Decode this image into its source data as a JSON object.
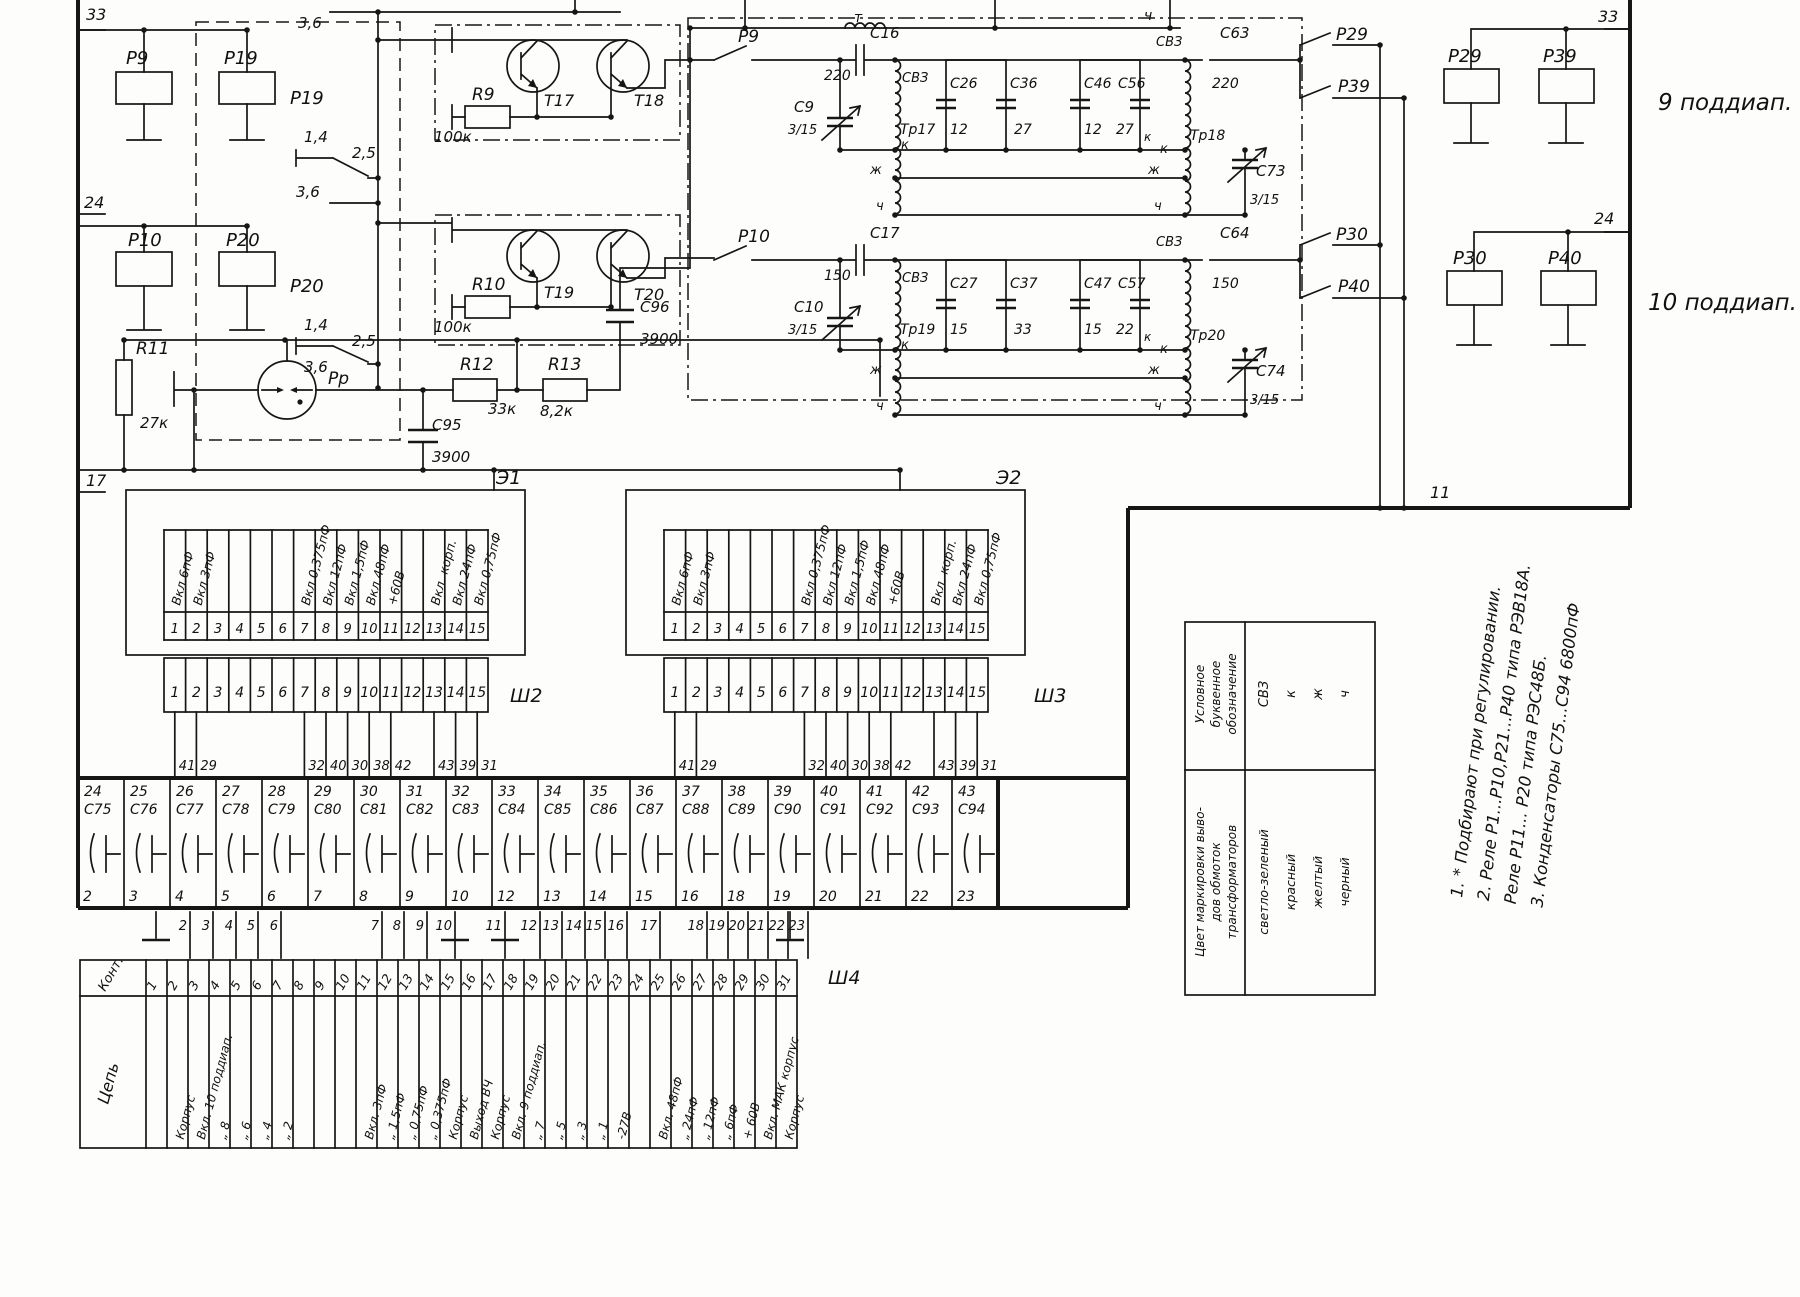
{
  "border": {
    "l33": "33",
    "l24": "24",
    "l17": "17",
    "r33": "33",
    "r24": "24"
  },
  "misc": {
    "e1": "Э1",
    "e2": "Э2",
    "sh2": "Ш2",
    "sh3": "Ш3",
    "sh4": "Ш4",
    "w11": "11",
    "band9": "9 поддиап.",
    "band10": "10 поддиап.",
    "t_mark": "т",
    "ch_top": "ч",
    "kont": "Конт.",
    "cep": "Цепь"
  },
  "relays": {
    "p9": "Р9",
    "p19": "Р19",
    "p10": "Р10",
    "p20": "Р20",
    "p29": "Р29",
    "p39": "Р39",
    "p30": "Р30",
    "p40": "Р40"
  },
  "sw": {
    "p19l": "Р19",
    "p19c14": "1,4",
    "p19c25": "2,5",
    "p19c36a": "3,6",
    "p19c36b": "3,6",
    "p20l": "Р20",
    "p20c14": "1,4",
    "p20c25": "2,5",
    "p20c36": "3,6",
    "rp": "Рр"
  },
  "amp_top": {
    "r": "R9",
    "rv": "100к",
    "t1": "Т17",
    "t2": "Т18"
  },
  "amp_bot": {
    "r": "R10",
    "rv": "100к",
    "t1": "Т19",
    "t2": "Т20"
  },
  "rc": {
    "r11": "R11",
    "r11v": "27к",
    "r12": "R12",
    "r12v": "33к",
    "r13": "R13",
    "r13v": "8,2к",
    "c95": "С95",
    "c95v": "3900",
    "c96": "С96",
    "c96v": "3900"
  },
  "flt": {
    "p9": "Р9",
    "c16": "С16",
    "c16v": "220",
    "c9": "С9",
    "c9v": "3/15",
    "svz1": "СВЗ",
    "tr1": "Тр17",
    "k1": "к",
    "zh1": "ж",
    "ch1": "ч",
    "c26": "С26",
    "c26v": "12",
    "c36": "С36",
    "c36v": "27",
    "c46": "С46",
    "c46v": "12",
    "c56": "С56",
    "c56v": "27",
    "k2": "к",
    "svz2": "СВЗ",
    "tr2": "Тр18",
    "zh2": "ж",
    "ch2": "ч",
    "k3": "к",
    "c63": "С63",
    "c63v": "220",
    "c73": "С73",
    "c73v": "3/15",
    "p29": "Р29",
    "p39": "Р39"
  },
  "flb": {
    "p10": "Р10",
    "c17": "С17",
    "c17v": "150",
    "c10": "С10",
    "c10v": "3/15",
    "svz1": "СВЗ",
    "tr1": "Тр19",
    "k1": "к",
    "zh1": "ж",
    "ch1": "ч",
    "c27": "С27",
    "c27v": "15",
    "c37": "С37",
    "c37v": "33",
    "c47": "С47",
    "c47v": "15",
    "c57": "С57",
    "c57v": "22",
    "k2": "к",
    "svz2": "СВЗ",
    "tr2": "Тр20",
    "zh2": "ж",
    "ch2": "ч",
    "k3": "к",
    "c64": "С64",
    "c64v": "150",
    "c74": "С74",
    "c74v": "3/15",
    "p30": "Р30",
    "p40": "Р40"
  },
  "e_cols": [
    {
      "n": "1",
      "t": "Вкл.6пФ"
    },
    {
      "n": "2",
      "t": "Вкл.3пФ"
    },
    {
      "n": "3",
      "t": ""
    },
    {
      "n": "4",
      "t": ""
    },
    {
      "n": "5",
      "t": ""
    },
    {
      "n": "6",
      "t": ""
    },
    {
      "n": "7",
      "t": "Вкл.0,375пФ"
    },
    {
      "n": "8",
      "t": "Вкл.12пФ"
    },
    {
      "n": "9",
      "t": "Вкл.1,5пФ"
    },
    {
      "n": "10",
      "t": "Вкл.48пФ"
    },
    {
      "n": "11",
      "t": "+60В"
    },
    {
      "n": "12",
      "t": ""
    },
    {
      "n": "13",
      "t": "Вкл. корп."
    },
    {
      "n": "14",
      "t": "Вкл.24пФ"
    },
    {
      "n": "15",
      "t": "Вкл.0,75пФ"
    }
  ],
  "wires_sh": [
    "41",
    "29",
    "32",
    "40",
    "30",
    "38",
    "42",
    "43",
    "39",
    "31"
  ],
  "band_cells": [
    {
      "top": "24",
      "ref": "С75",
      "bot": "2"
    },
    {
      "top": "25",
      "ref": "С76",
      "bot": "3"
    },
    {
      "top": "26",
      "ref": "С77",
      "bot": "4"
    },
    {
      "top": "27",
      "ref": "С78",
      "bot": "5"
    },
    {
      "top": "28",
      "ref": "С79",
      "bot": "6"
    },
    {
      "top": "29",
      "ref": "С80",
      "bot": "7"
    },
    {
      "top": "30",
      "ref": "С81",
      "bot": "8"
    },
    {
      "top": "31",
      "ref": "С82",
      "bot": "9"
    },
    {
      "top": "32",
      "ref": "С83",
      "bot": "10"
    },
    {
      "top": "33",
      "ref": "С84",
      "bot": "12"
    },
    {
      "top": "34",
      "ref": "С85",
      "bot": "13"
    },
    {
      "top": "35",
      "ref": "С86",
      "bot": "14"
    },
    {
      "top": "36",
      "ref": "С87",
      "bot": "15"
    },
    {
      "top": "37",
      "ref": "С88",
      "bot": "16"
    },
    {
      "top": "38",
      "ref": "С89",
      "bot": "18"
    },
    {
      "top": "39",
      "ref": "С90",
      "bot": "19"
    },
    {
      "top": "40",
      "ref": "С91",
      "bot": "20"
    },
    {
      "top": "41",
      "ref": "С92",
      "bot": "21"
    },
    {
      "top": "42",
      "ref": "С93",
      "bot": "22"
    },
    {
      "top": "43",
      "ref": "С94",
      "bot": "23"
    }
  ],
  "wires_band": [
    "2",
    "3",
    "4",
    "5",
    "6",
    "7",
    "8",
    "9",
    "10",
    "11",
    "12",
    "13",
    "14",
    "15",
    "16",
    "17",
    "18",
    "19",
    "20",
    "21",
    "22",
    "23"
  ],
  "sh4_cols": [
    {
      "n": "1",
      "t": ""
    },
    {
      "n": "2",
      "t": "Корпус"
    },
    {
      "n": "3",
      "t": "Вкл. 10 поддиап."
    },
    {
      "n": "4",
      "t": "„ 8"
    },
    {
      "n": "5",
      "t": "„ 6"
    },
    {
      "n": "6",
      "t": "„ 4"
    },
    {
      "n": "7",
      "t": "„ 2"
    },
    {
      "n": "8",
      "t": ""
    },
    {
      "n": "9",
      "t": ""
    },
    {
      "n": "10",
      "t": ""
    },
    {
      "n": "11",
      "t": "Вкл. 3пФ"
    },
    {
      "n": "12",
      "t": "„ 1,5пФ"
    },
    {
      "n": "13",
      "t": "„ 0,75пФ"
    },
    {
      "n": "14",
      "t": "„ 0,375пФ"
    },
    {
      "n": "15",
      "t": "Корпус"
    },
    {
      "n": "16",
      "t": "Выход ВЧ"
    },
    {
      "n": "17",
      "t": "Корпус"
    },
    {
      "n": "18",
      "t": "Вкл. 9 поддиап."
    },
    {
      "n": "19",
      "t": "„ 7"
    },
    {
      "n": "20",
      "t": "„ 5"
    },
    {
      "n": "21",
      "t": "„ 3"
    },
    {
      "n": "22",
      "t": "„ 1"
    },
    {
      "n": "23",
      "t": "-27В"
    },
    {
      "n": "24",
      "t": ""
    },
    {
      "n": "25",
      "t": "Вкл. 48пФ"
    },
    {
      "n": "26",
      "t": "„ 24пФ"
    },
    {
      "n": "27",
      "t": "„ 12пФ"
    },
    {
      "n": "28",
      "t": "„ 6пФ"
    },
    {
      "n": "29",
      "t": "+ 60В"
    },
    {
      "n": "30",
      "t": "Вкл. МАК корпус"
    },
    {
      "n": "31",
      "t": "Корпус"
    }
  ],
  "color_table": {
    "h1": [
      "Условное",
      "буквенное",
      "обозначение"
    ],
    "h2": [
      "Цвет маркировки выво-",
      "дов обмоток",
      "трансформаторов"
    ],
    "codes": [
      "СВЗ",
      "к",
      "ж",
      "ч"
    ],
    "colors": [
      "светло-зеленый",
      "красный",
      "желтый",
      "черный"
    ]
  },
  "notes": [
    "1. * Подбирают  при  регулировании.",
    "2. Реле Р1...Р10,Р21...Р40  типа  РЭВ18А.",
    "Реле Р11... Р20   типа   РЭС48Б.",
    "3. Конденсаторы  С75...С94   6800пФ"
  ]
}
